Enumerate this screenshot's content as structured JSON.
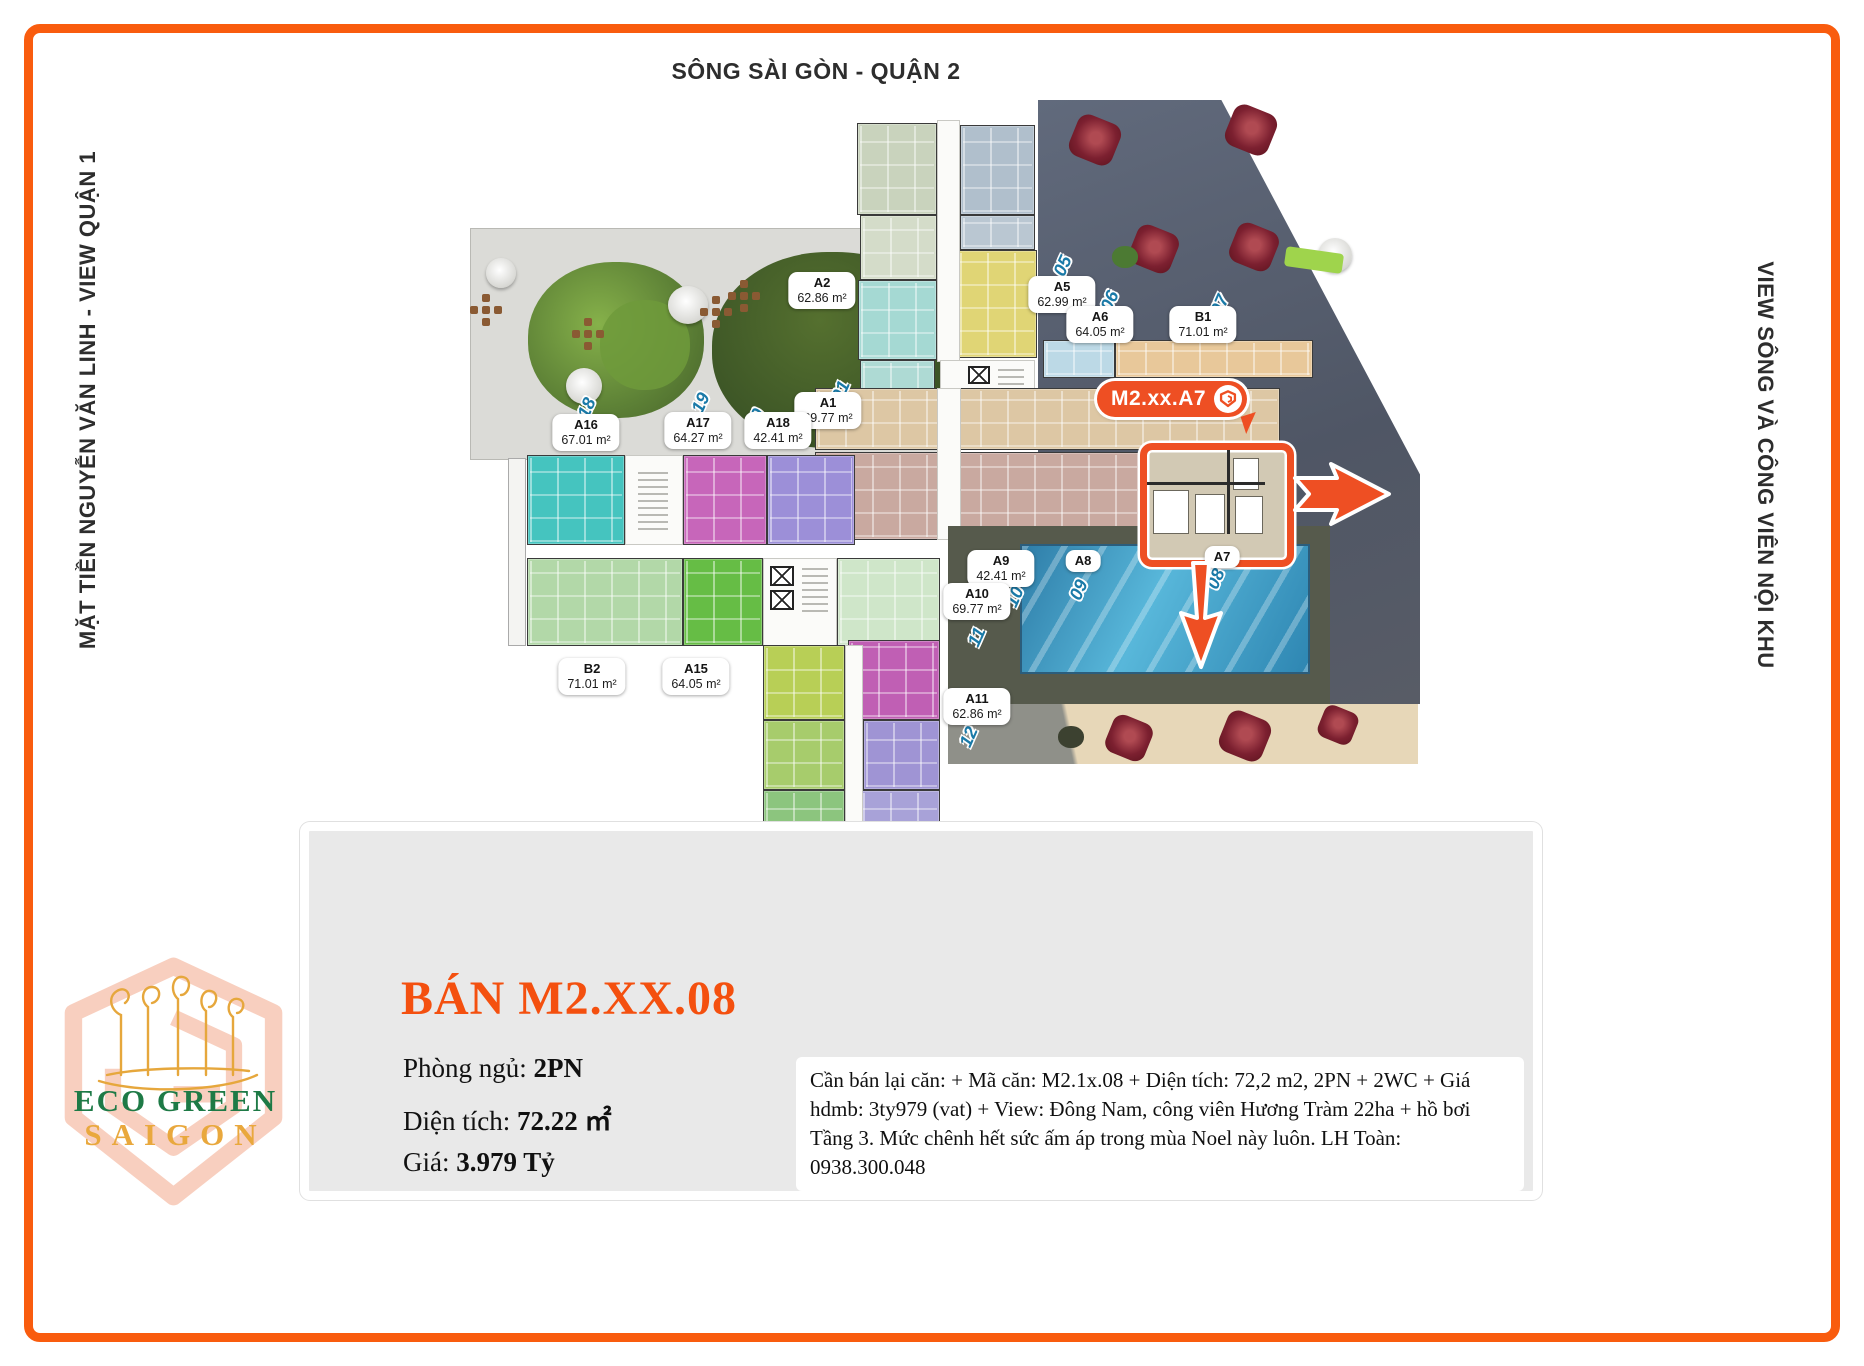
{
  "labels": {
    "top": "SÔNG SÀI GÒN - QUẬN 2",
    "left": "MẶT TIỀN NGUYỄN VĂN LINH - VIEW QUẬN 1",
    "right": "VIEW SÔNG VÀ CÔNG VIÊN NỘI KHU",
    "park": "CÔNG VIÊN HƯƠNG TRÀM 22HA"
  },
  "callout": {
    "label": "M2.xx.A7"
  },
  "plan": {
    "units": [
      {
        "id": "A2",
        "area": "62.86 m²",
        "x": 822,
        "y": 272
      },
      {
        "id": "A5",
        "area": "62.99 m²",
        "x": 1062,
        "y": 276
      },
      {
        "id": "A6",
        "area": "64.05 m²",
        "x": 1100,
        "y": 306
      },
      {
        "id": "B1",
        "area": "71.01 m²",
        "x": 1203,
        "y": 306
      },
      {
        "id": "A1",
        "area": "69.77 m²",
        "x": 828,
        "y": 392
      },
      {
        "id": "A16",
        "area": "67.01 m²",
        "x": 586,
        "y": 414
      },
      {
        "id": "A17",
        "area": "64.27 m²",
        "x": 698,
        "y": 412
      },
      {
        "id": "A18",
        "area": "42.41 m²",
        "x": 778,
        "y": 412
      },
      {
        "id": "B2",
        "area": "71.01 m²",
        "x": 592,
        "y": 658
      },
      {
        "id": "A15",
        "area": "64.05 m²",
        "x": 696,
        "y": 658
      },
      {
        "id": "A9",
        "area": "42.41 m²",
        "x": 1001,
        "y": 550
      },
      {
        "id": "A10",
        "area": "69.77 m²",
        "x": 977,
        "y": 583
      },
      {
        "id": "A11",
        "area": "62.86 m²",
        "x": 977,
        "y": 688
      },
      {
        "id": "A8",
        "area": "",
        "x": 1083,
        "y": 550
      },
      {
        "id": "A7",
        "area": "",
        "x": 1222,
        "y": 546
      }
    ],
    "numbers": [
      {
        "n": "05",
        "x": 1063,
        "y": 266
      },
      {
        "n": "06",
        "x": 1110,
        "y": 301
      },
      {
        "n": "07",
        "x": 1220,
        "y": 305
      },
      {
        "n": "01",
        "x": 841,
        "y": 391
      },
      {
        "n": "18",
        "x": 587,
        "y": 408
      },
      {
        "n": "19",
        "x": 701,
        "y": 403
      },
      {
        "n": "20",
        "x": 756,
        "y": 419
      },
      {
        "n": "09",
        "x": 1079,
        "y": 590
      },
      {
        "n": "10",
        "x": 1015,
        "y": 597
      },
      {
        "n": "11",
        "x": 977,
        "y": 637
      },
      {
        "n": "12",
        "x": 969,
        "y": 737
      },
      {
        "n": "08",
        "x": 1216,
        "y": 579
      }
    ]
  },
  "panel": {
    "title": "BÁN M2.XX.08",
    "bedrooms_label": "Phòng ngủ:",
    "bedrooms_value": "2PN",
    "area_label": "Diện tích:",
    "area_value": "72.22 ㎡",
    "price_label": "Giá:",
    "price_value": "3.979 Tỷ",
    "description": "Cần bán lại căn: + Mã căn: M2.1x.08 + Diện tích: 72,2 m2, 2PN + 2WC + Giá hdmb: 3ty979 (vat) + View: Đông Nam, công viên Hương Tràm 22ha + hồ bơi Tầng 3. Mức chênh hết sức ấm áp trong mùa Noel này luôn. LH Toàn: 0938.300.048"
  },
  "logo": {
    "line1": "ECO GREEN",
    "line2": "SAIGON"
  },
  "colors": {
    "frame": "#f95c0e",
    "accent": "#ee4f23",
    "title": "#f4500f",
    "panel_bg": "#e9e9e9",
    "blue_number": "#1a7aa8",
    "logo_green": "#1e7a46",
    "logo_gold": "#e9a83d"
  }
}
